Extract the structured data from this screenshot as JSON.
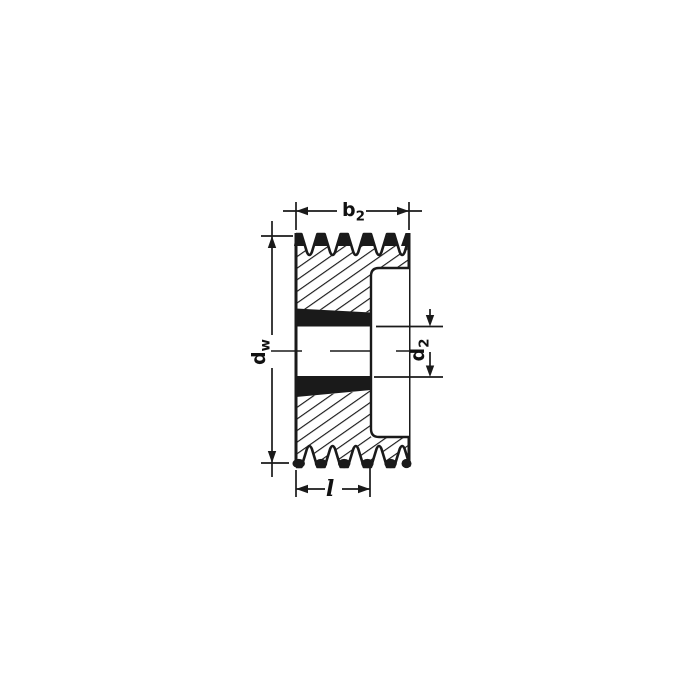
{
  "page": {
    "background": "#ffffff",
    "ink_color": "#1a1a1a"
  },
  "drawing": {
    "name": "v-belt-pulley-cross-section",
    "description": "Sectional technical drawing of a multi-groove V-belt pulley with taper bushing hub",
    "groove_count": 5,
    "labels": {
      "b2": {
        "base": "b",
        "sub": "2"
      },
      "dw": {
        "base": "d",
        "sub": "w"
      },
      "d2": {
        "base": "d",
        "sub": "2"
      },
      "l": {
        "base": "l"
      }
    }
  }
}
